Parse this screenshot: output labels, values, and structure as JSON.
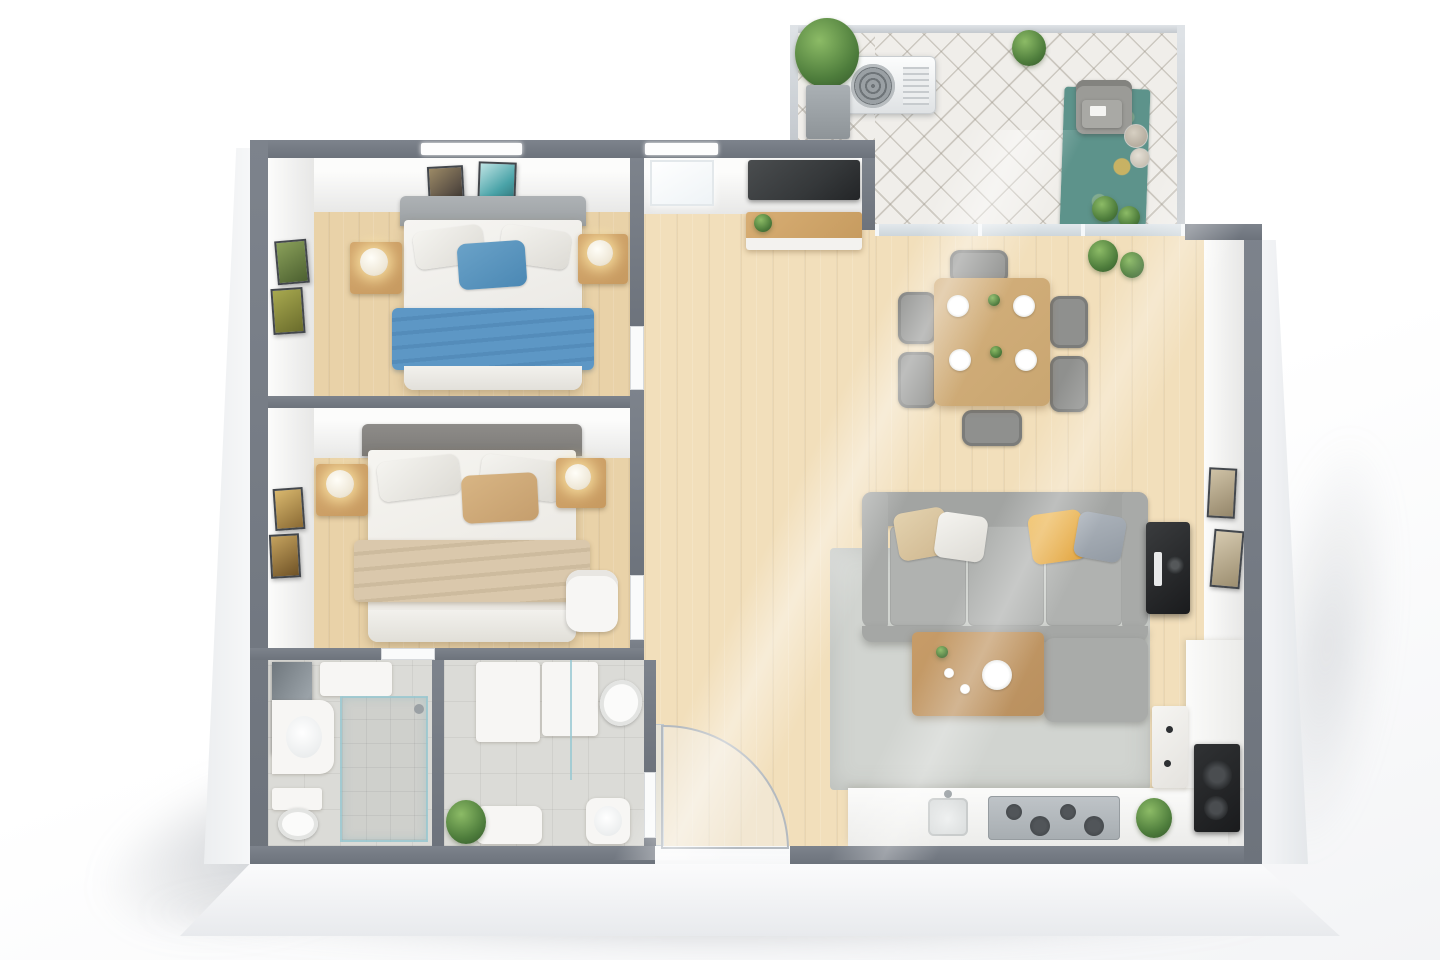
{
  "scene": {
    "title": "3D floor plan of a two-bedroom apartment",
    "description": "Top-down 3D render of a furnished two-bedroom apartment: two bedrooms with double beds and nightstands, en-suite bathroom plus second bathroom, entry hall with open door, TV wall with sideboard, open living-dining room with grey sofa, coffee table, rug, dining table with six chairs, open kitchen with cooktop and black sink unit, and a diamond-tiled balcony with air-conditioning unit, armchair, teal rug and potted plants.",
    "colors": {
      "wall": "#6d737c",
      "wood": "#e9d2a8",
      "woodlight": "#f2dfbb",
      "tile": "#dbdbd7",
      "balconytile": "#f0eeea",
      "glassdoor": "#cdd6db",
      "railing": "#c4c9ce",
      "bluepillow": "#4b88b4",
      "blueblanket": "#5d97c5",
      "tanpillow": "#c59e6d",
      "tanblanket": "#dac8ac",
      "sofagray": "#a9aba9",
      "yellowpillow": "#e2a43e",
      "ruggray": "#d1d4d0",
      "rugteal": "#5d938b",
      "nightstand": "#c79a60",
      "diningtable": "#c9a671",
      "coffeetable": "#b9905f",
      "tvscreen": "#35383a",
      "blackunit": "#1a1b1d",
      "plantgreen": "#4e7d3c",
      "headboard1": "#9ba0a3",
      "headboard2": "#7c7a77"
    },
    "rooms": [
      {
        "id": "bedroom-1",
        "label": "Bedroom 1",
        "items": [
          "double bed with grey headboard",
          "white bedding",
          "blue accent pillow",
          "blue throw blanket",
          "2 wooden nightstands",
          "2 glowing table lamps",
          "2 picture frames above bed",
          "2 picture frames on side wall",
          "window"
        ]
      },
      {
        "id": "bedroom-2",
        "label": "Bedroom 2",
        "items": [
          "double bed with dark grey headboard",
          "white bedding",
          "tan accent pillow",
          "beige throw blanket",
          "2 wooden nightstands",
          "2 glowing table lamps",
          "2 picture frames on side wall",
          "white armchair"
        ]
      },
      {
        "id": "bathroom-1",
        "label": "En-suite bathroom",
        "items": [
          "mirror vanity",
          "washbasin",
          "toilet",
          "walk-in shower with glass screen",
          "shelf"
        ]
      },
      {
        "id": "bathroom-2",
        "label": "Second bathroom",
        "items": [
          "storage cabinets",
          "toilet",
          "washbasin",
          "low cabinet",
          "potted plant",
          "grey tiled floor"
        ]
      },
      {
        "id": "hallway",
        "label": "Entry hall",
        "items": [
          "open entrance door with swing arc",
          "wall-mounted TV",
          "TV sideboard with plant",
          "window"
        ]
      },
      {
        "id": "living-dining",
        "label": "Living / dining room",
        "items": [
          "grey 3-seat sofa",
          "beige, white, yellow and grey cushions",
          "grey ottoman",
          "wooden coffee table with tableware",
          "light grey rug",
          "black side unit",
          "wooden dining table",
          "6 grey dining chairs",
          "4 place settings",
          "2 picture frames on wall",
          "potted plants"
        ]
      },
      {
        "id": "kitchen",
        "label": "Open kitchen",
        "items": [
          "white counter",
          "cooktop with burners",
          "sink with faucet",
          "tall white cabinet",
          "black built-in sink unit",
          "potted plant in niche"
        ]
      },
      {
        "id": "balcony",
        "label": "Balcony",
        "items": [
          "diamond-tiled floor",
          "glass railing",
          "air-conditioning unit",
          "tall potted plant in planter",
          "armchair with side table",
          "teal patterned rug",
          "planter pots",
          "small potted plants",
          "glass sliding door"
        ]
      }
    ]
  }
}
